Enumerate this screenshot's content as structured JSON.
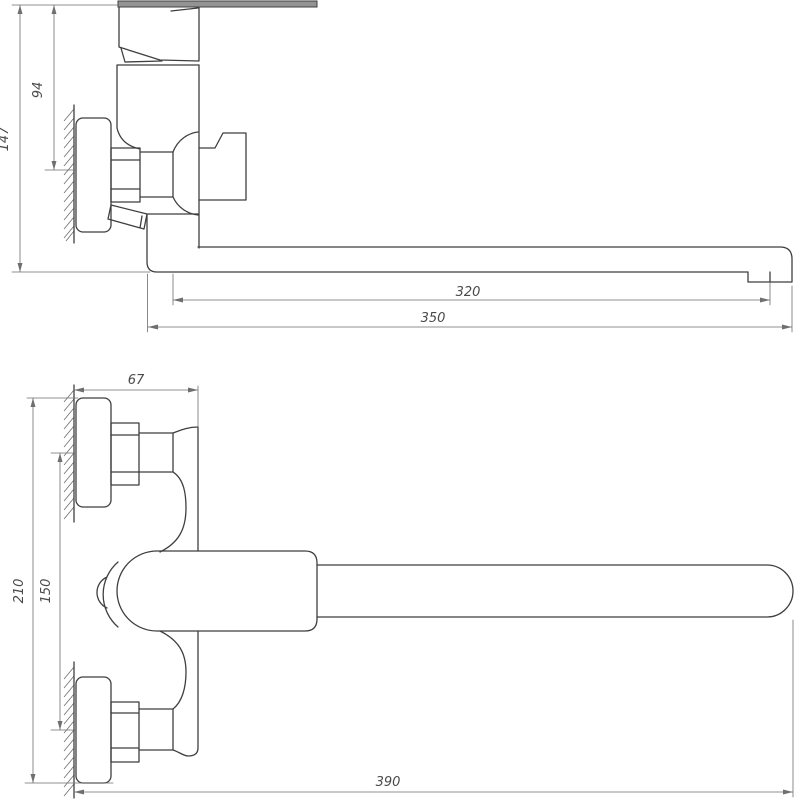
{
  "drawing": {
    "kind": "technical-dimension-drawing",
    "subject": "wall-mounted single-lever bathtub mixer faucet with long spout",
    "colors": {
      "background": "#ffffff",
      "outline": "#3f3f3f",
      "dimension": "#6f6f6f",
      "text": "#4a4a4a",
      "lever_fill": "#949494"
    },
    "side_view": {
      "name": "side view",
      "dimensions": [
        {
          "id": "overall-height",
          "label": "147"
        },
        {
          "id": "top-to-inlet-axis",
          "label": "94"
        },
        {
          "id": "reach-to-aerator",
          "label": "320"
        },
        {
          "id": "reach-overall",
          "label": "350"
        }
      ]
    },
    "front_view": {
      "name": "front view",
      "dimensions": [
        {
          "id": "wall-to-body-front",
          "label": "67"
        },
        {
          "id": "escutcheon-outer-span",
          "label": "210"
        },
        {
          "id": "inlet-centers-span",
          "label": "150"
        },
        {
          "id": "overall-length",
          "label": "390"
        }
      ]
    }
  }
}
